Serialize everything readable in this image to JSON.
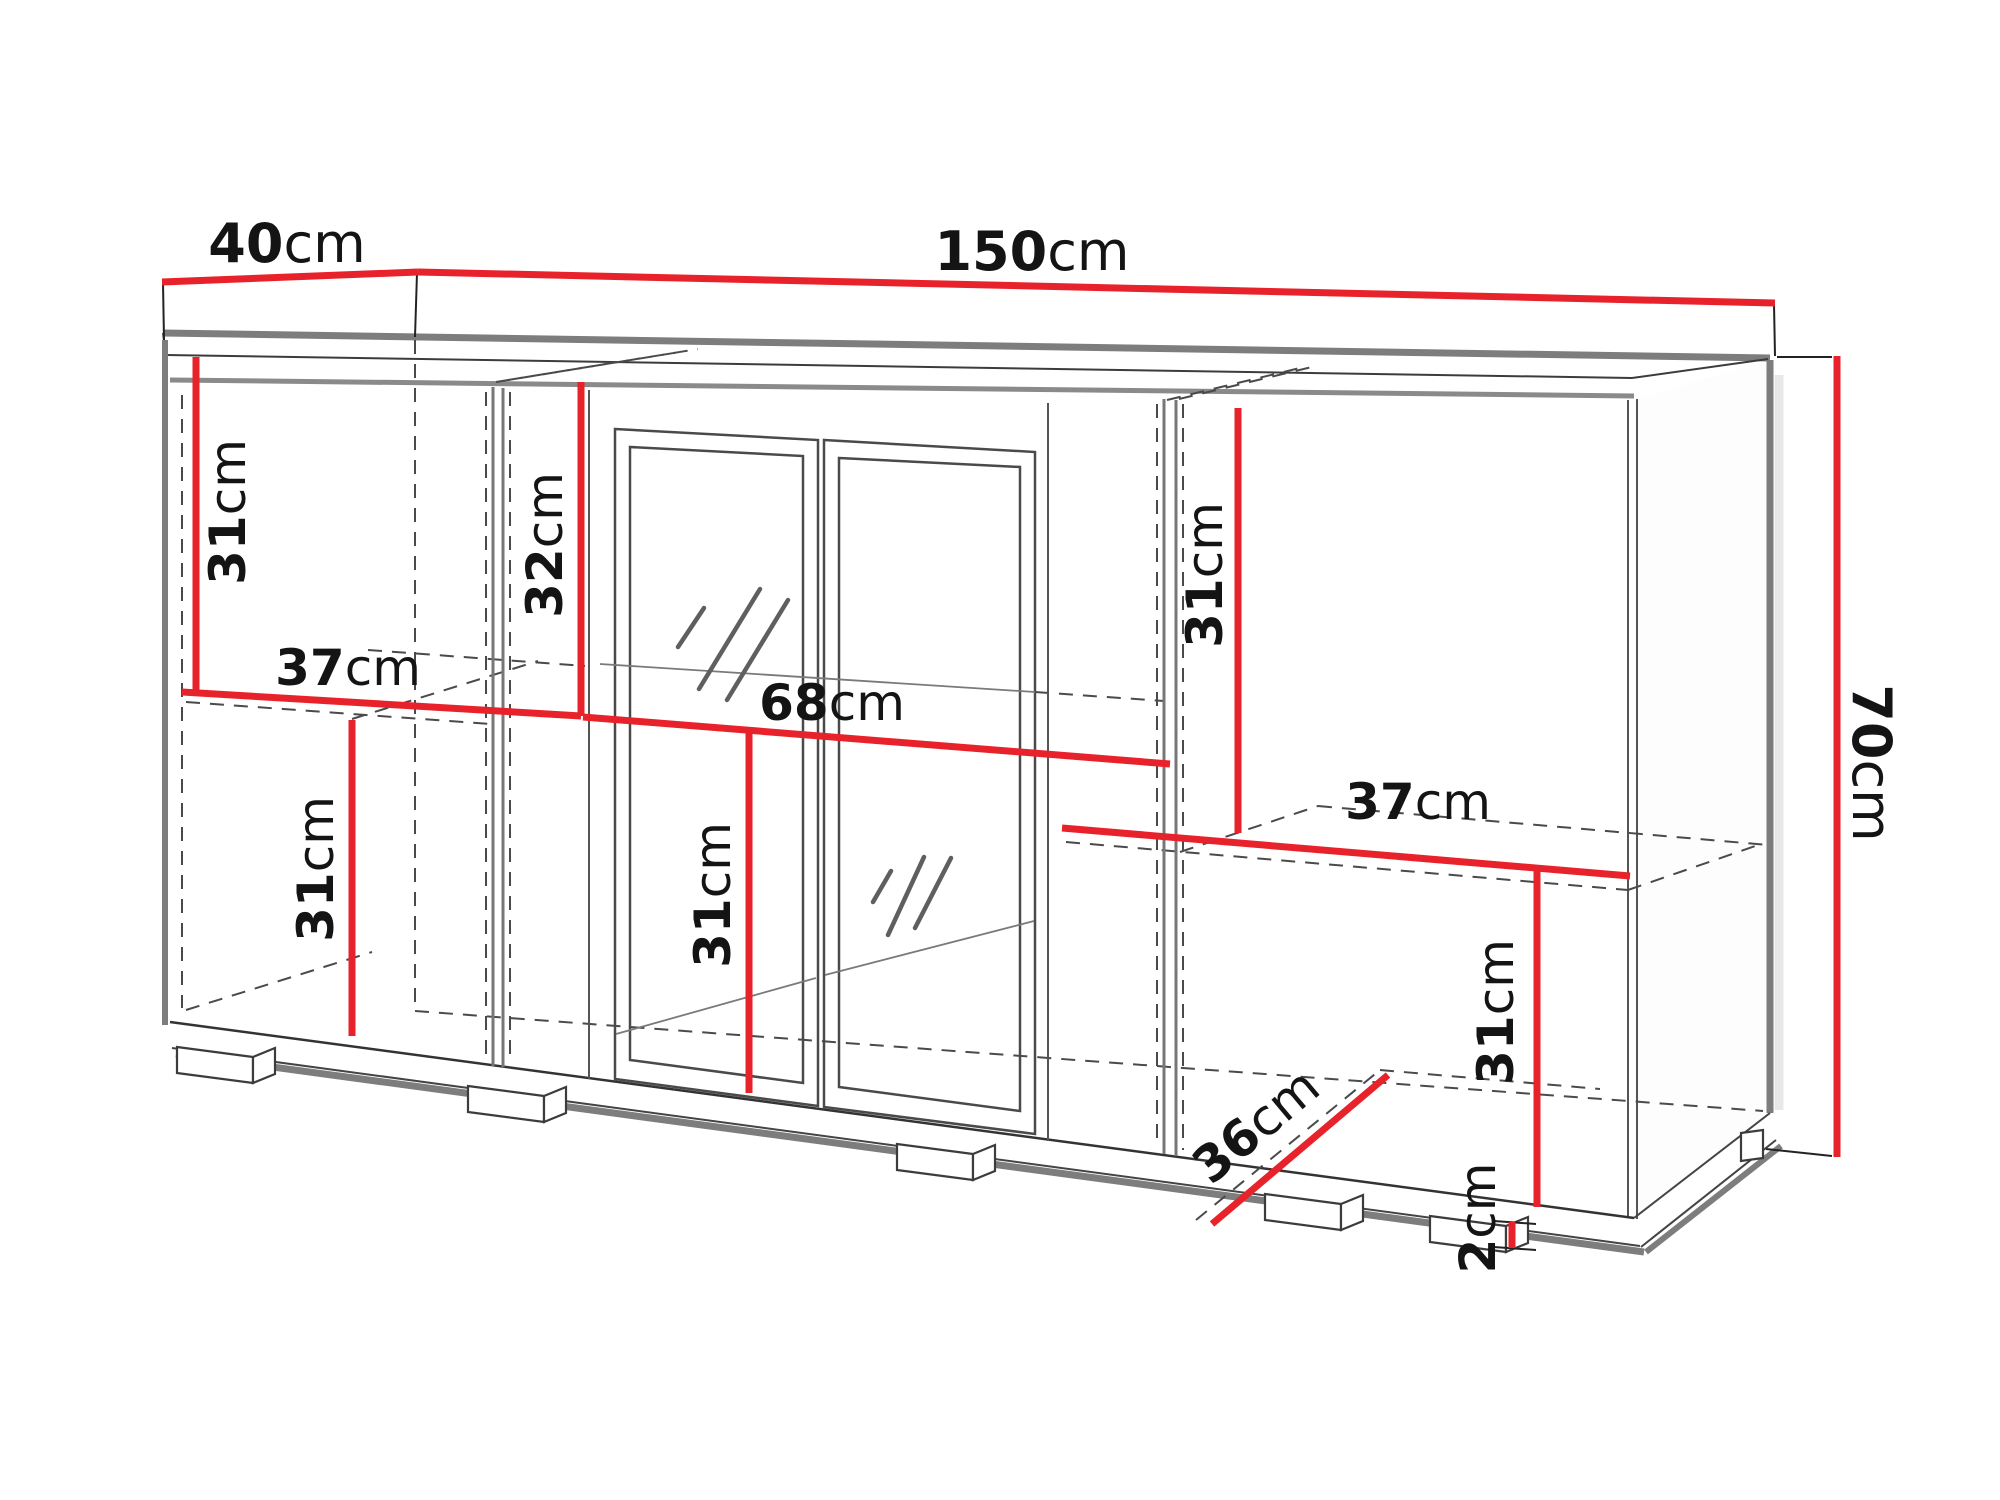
{
  "diagram": {
    "name": "sideboard-dimension-diagram",
    "overall": {
      "width": "150cm",
      "depth": "40cm",
      "height": "70cm"
    },
    "colors": {
      "dimension_red": "#e8222a",
      "edge_gray": "#7d7d7d",
      "line_dark": "#3c3c3c",
      "hidden_dash": "#4a4a4a",
      "text": "#141414",
      "shadow": "#d9d9d9",
      "background": "#ffffff"
    },
    "dimensions": [
      {
        "id": "depth-40cm",
        "value": "40",
        "unit": "cm",
        "label_x": 287,
        "label_y": 243,
        "rotate": 0,
        "size": 54,
        "line": [
          162,
          282,
          418,
          272
        ]
      },
      {
        "id": "width-150cm",
        "value": "150",
        "unit": "cm",
        "label_x": 1032,
        "label_y": 251,
        "rotate": 0,
        "size": 54,
        "line": [
          418,
          272,
          1775,
          303
        ]
      },
      {
        "id": "height-70cm",
        "value": "70",
        "unit": "cm",
        "label_x": 1872,
        "label_y": 763,
        "rotate": 90,
        "size": 54,
        "line": [
          1837,
          356,
          1837,
          1157
        ]
      },
      {
        "id": "upper-left-31cm",
        "value": "31",
        "unit": "cm",
        "label_x": 228,
        "label_y": 512,
        "rotate": -90,
        "size": 50,
        "line": [
          196,
          357,
          196,
          692
        ]
      },
      {
        "id": "glass-top-32cm",
        "value": "32",
        "unit": "cm",
        "label_x": 545,
        "label_y": 545,
        "rotate": -90,
        "size": 50,
        "line": [
          581,
          382,
          581,
          716
        ]
      },
      {
        "id": "left-shelf-37cm",
        "value": "37",
        "unit": "cm",
        "label_x": 348,
        "label_y": 668,
        "rotate": 0,
        "size": 50,
        "line": [
          182,
          692,
          581,
          716
        ]
      },
      {
        "id": "center-shelf-68cm",
        "value": "68",
        "unit": "cm",
        "label_x": 832,
        "label_y": 703,
        "rotate": 0,
        "size": 50,
        "line": [
          583,
          717,
          1170,
          764
        ]
      },
      {
        "id": "upper-right-31cm",
        "value": "31",
        "unit": "cm",
        "label_x": 1205,
        "label_y": 575,
        "rotate": -90,
        "size": 50,
        "line": [
          1238,
          408,
          1238,
          833
        ]
      },
      {
        "id": "right-shelf-37cm",
        "value": "37",
        "unit": "cm",
        "label_x": 1418,
        "label_y": 802,
        "rotate": 0,
        "size": 50,
        "line": [
          1062,
          828,
          1630,
          876
        ]
      },
      {
        "id": "lower-left-31cm",
        "value": "31",
        "unit": "cm",
        "label_x": 316,
        "label_y": 869,
        "rotate": -90,
        "size": 50,
        "line": [
          352,
          720,
          352,
          1036
        ]
      },
      {
        "id": "lower-center-31cm",
        "value": "31",
        "unit": "cm",
        "label_x": 713,
        "label_y": 895,
        "rotate": -90,
        "size": 50,
        "line": [
          749,
          730,
          749,
          1093
        ]
      },
      {
        "id": "bottom-depth-36cm",
        "value": "36",
        "unit": "cm",
        "label_x": 1256,
        "label_y": 1126,
        "rotate": -40,
        "size": 50,
        "line": [
          1212,
          1224,
          1388,
          1075
        ]
      },
      {
        "id": "lower-right-31cm",
        "value": "31",
        "unit": "cm",
        "label_x": 1496,
        "label_y": 1012,
        "rotate": -90,
        "size": 50,
        "line": [
          1537,
          870,
          1537,
          1207
        ]
      },
      {
        "id": "foot-height-2cm",
        "value": "2",
        "unit": "cm",
        "label_x": 1478,
        "label_y": 1218,
        "rotate": -90,
        "size": 50,
        "line": [
          1512,
          1222,
          1512,
          1248
        ]
      }
    ]
  }
}
